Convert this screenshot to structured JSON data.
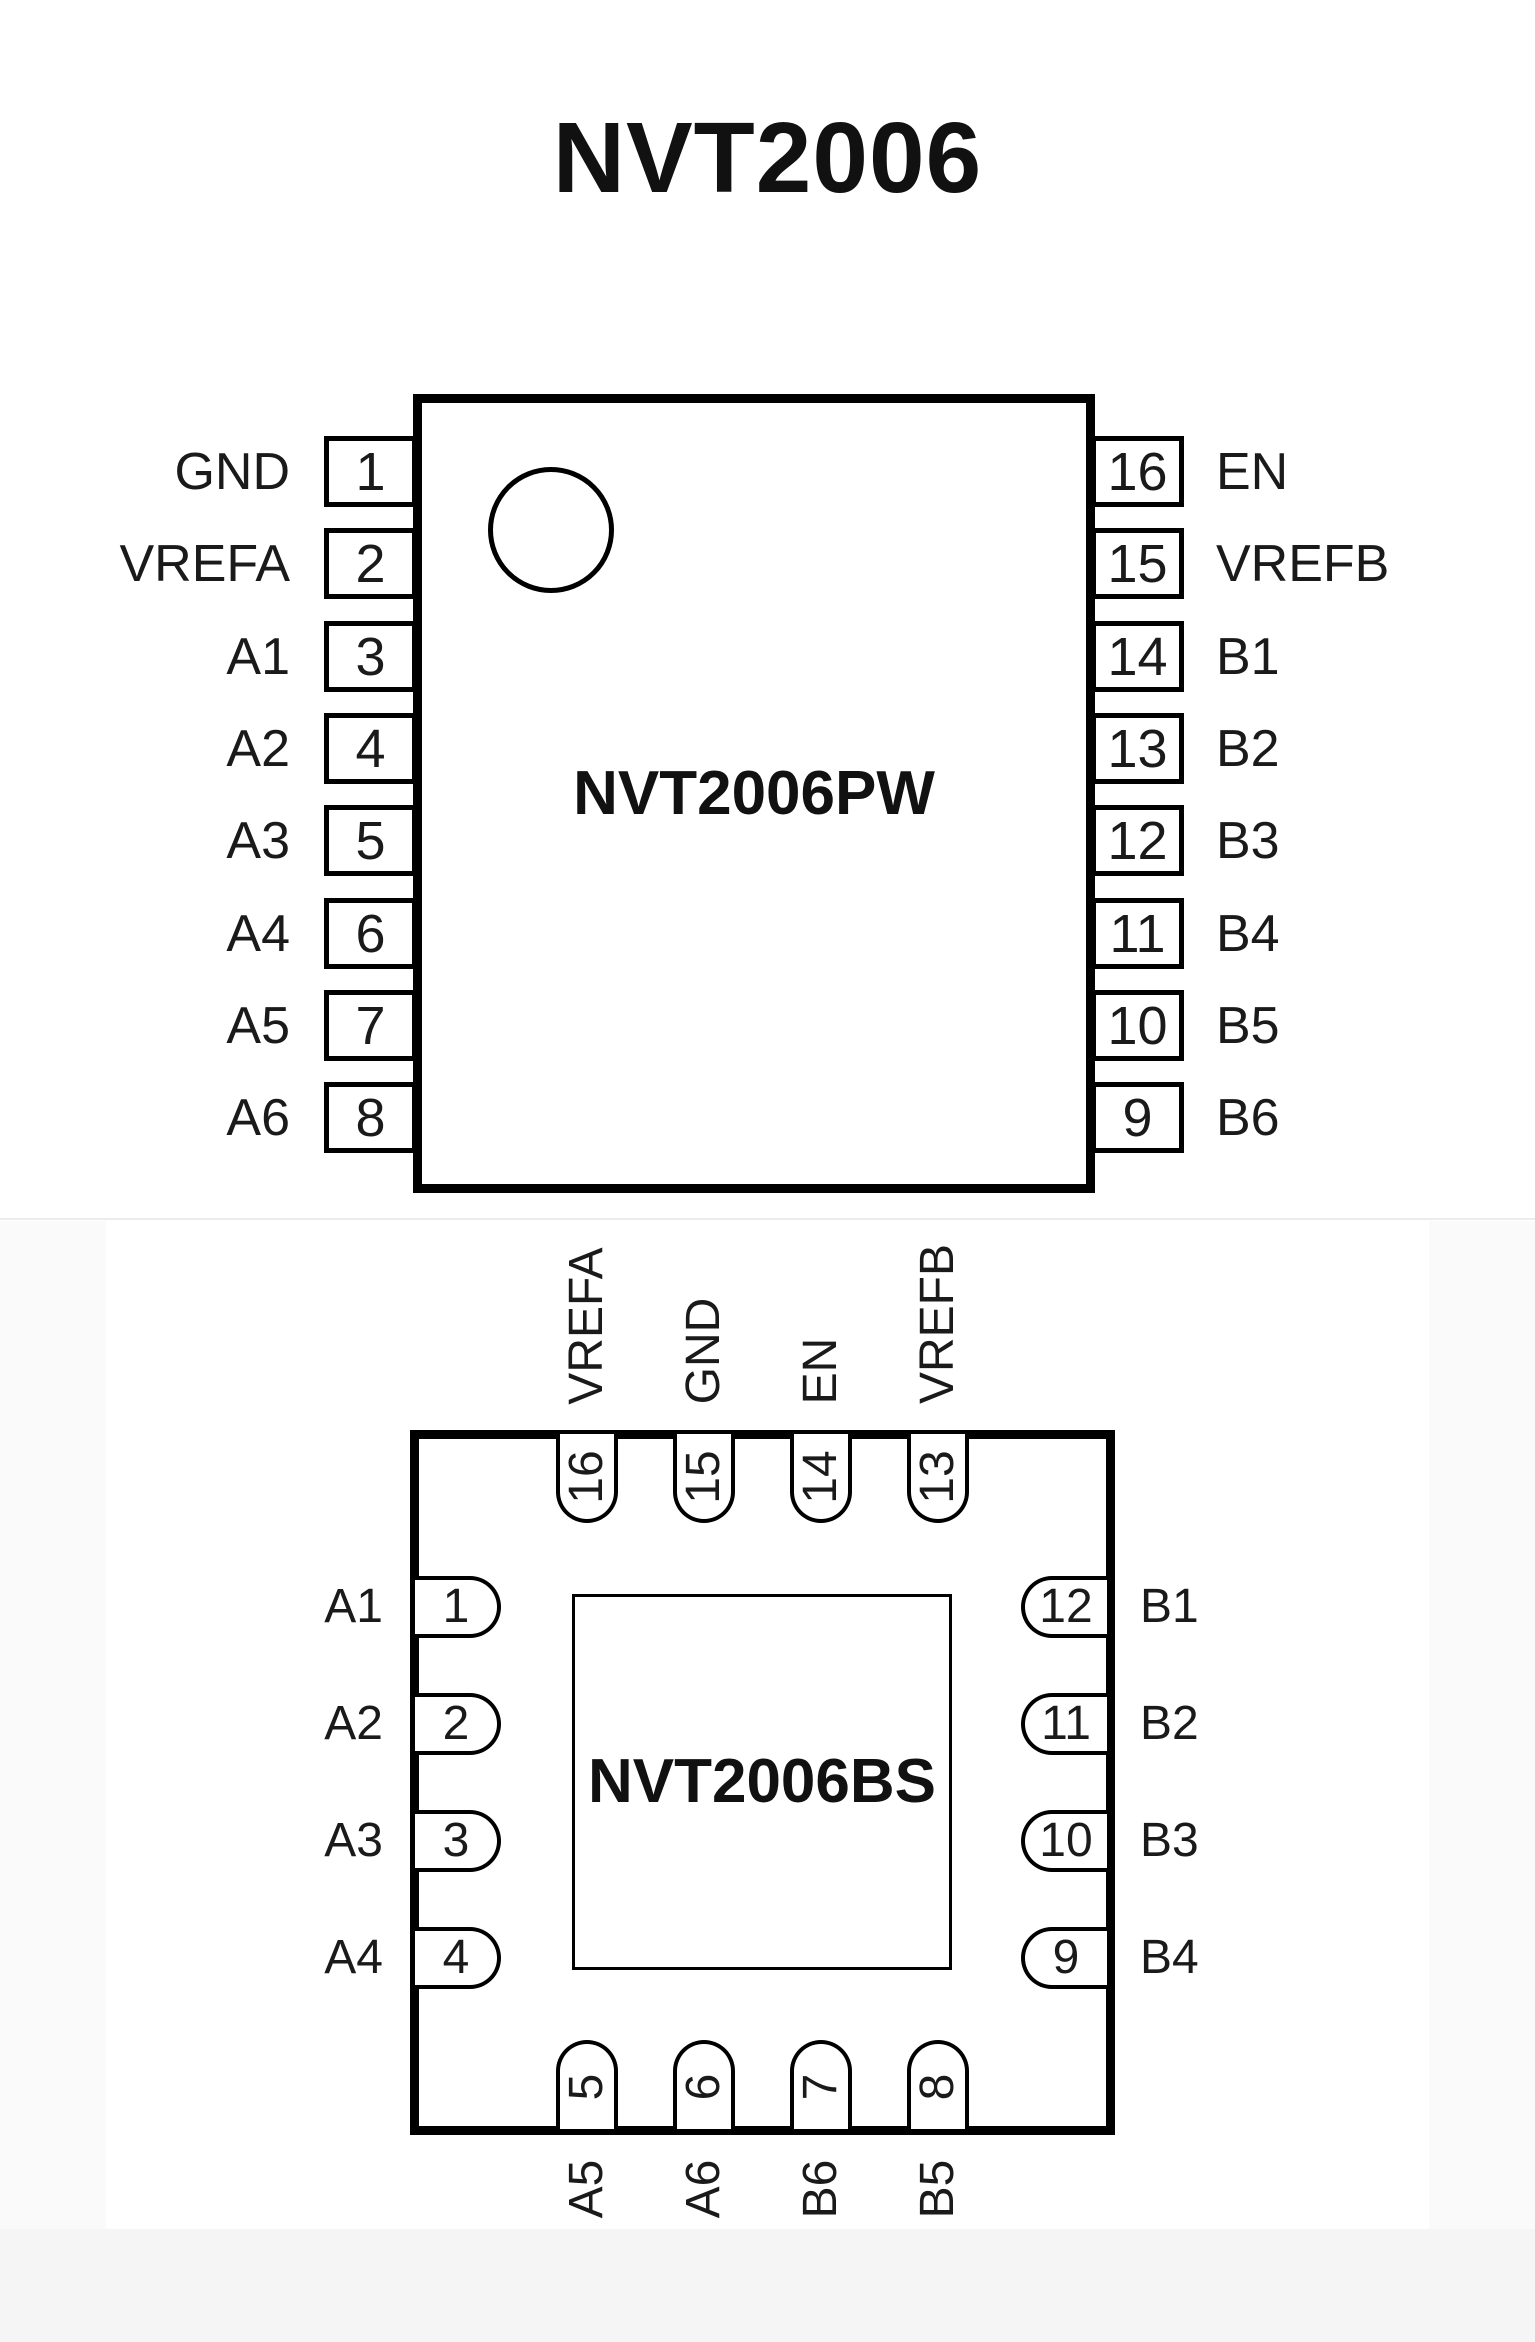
{
  "title": "NVT2006",
  "colors": {
    "ink": "#000000",
    "text": "#1a1a1a",
    "background": "#ffffff"
  },
  "packages": [
    {
      "name": "NVT2006PW",
      "style": "tssop16-dual-inline",
      "left_pins": [
        {
          "num": "1",
          "label": "GND"
        },
        {
          "num": "2",
          "label": "VREFA"
        },
        {
          "num": "3",
          "label": "A1"
        },
        {
          "num": "4",
          "label": "A2"
        },
        {
          "num": "5",
          "label": "A3"
        },
        {
          "num": "6",
          "label": "A4"
        },
        {
          "num": "7",
          "label": "A5"
        },
        {
          "num": "8",
          "label": "A6"
        }
      ],
      "right_pins": [
        {
          "num": "16",
          "label": "EN"
        },
        {
          "num": "15",
          "label": "VREFB"
        },
        {
          "num": "14",
          "label": "B1"
        },
        {
          "num": "13",
          "label": "B2"
        },
        {
          "num": "12",
          "label": "B3"
        },
        {
          "num": "11",
          "label": "B4"
        },
        {
          "num": "10",
          "label": "B5"
        },
        {
          "num": "9",
          "label": "B6"
        }
      ]
    },
    {
      "name": "NVT2006BS",
      "style": "hvqfn16-quad",
      "top_pins": [
        {
          "num": "16",
          "label": "VREFA"
        },
        {
          "num": "15",
          "label": "GND"
        },
        {
          "num": "14",
          "label": "EN"
        },
        {
          "num": "13",
          "label": "VREFB"
        }
      ],
      "left_pins": [
        {
          "num": "1",
          "label": "A1"
        },
        {
          "num": "2",
          "label": "A2"
        },
        {
          "num": "3",
          "label": "A3"
        },
        {
          "num": "4",
          "label": "A4"
        }
      ],
      "right_pins": [
        {
          "num": "12",
          "label": "B1"
        },
        {
          "num": "11",
          "label": "B2"
        },
        {
          "num": "10",
          "label": "B3"
        },
        {
          "num": "9",
          "label": "B4"
        }
      ],
      "bottom_pins": [
        {
          "num": "5",
          "label": "A5"
        },
        {
          "num": "6",
          "label": "A6"
        },
        {
          "num": "7",
          "label": "B6"
        },
        {
          "num": "8",
          "label": "B5"
        }
      ]
    }
  ]
}
